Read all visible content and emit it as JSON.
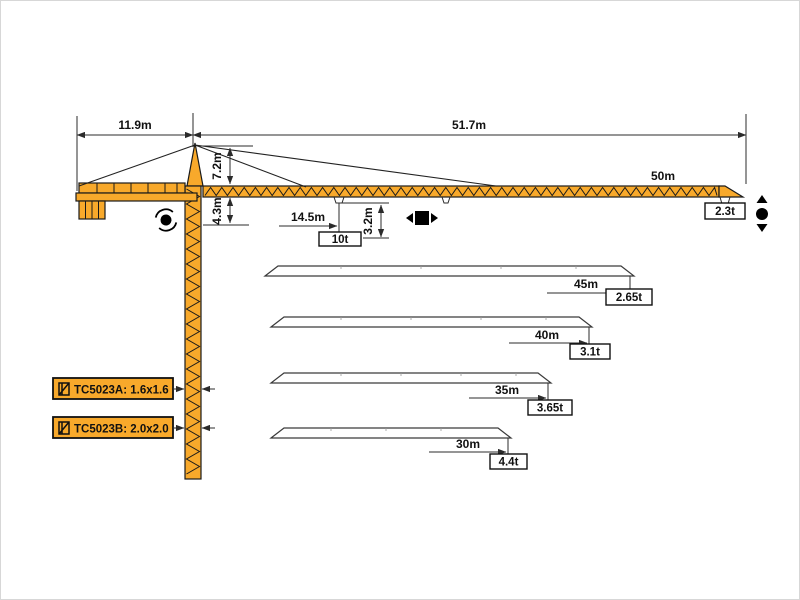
{
  "colors": {
    "crane_orange": "#F8A92B",
    "outline": "#1A1A1A",
    "dimension": "#2B2B2B",
    "silhouette_stroke": "#3A3A3A"
  },
  "dimensions": {
    "counter_jib_length": "11.9m",
    "jib_span": "51.7m",
    "tower_head_height": "7.2m",
    "under_jib_height": "4.3m",
    "trolley_distance": "14.5m",
    "max_load": "10t",
    "hook_drop": "3.2m",
    "main_jib_length": "50m",
    "tip_load_50m": "2.3t"
  },
  "jib_variants": [
    {
      "length": "45m",
      "tip_load": "2.65t"
    },
    {
      "length": "40m",
      "tip_load": "3.1t"
    },
    {
      "length": "35m",
      "tip_load": "3.65t"
    },
    {
      "length": "30m",
      "tip_load": "4.4t"
    }
  ],
  "models": [
    {
      "label": "TC5023A: 1.6x1.6"
    },
    {
      "label": "TC5023B: 2.0x2.0"
    }
  ],
  "icons": {
    "slewing": "slewing-rotation-icon",
    "trolley": "trolley-travel-icon",
    "hook": "hook-hoist-icon",
    "mast_section": "mast-cross-section-icon"
  }
}
